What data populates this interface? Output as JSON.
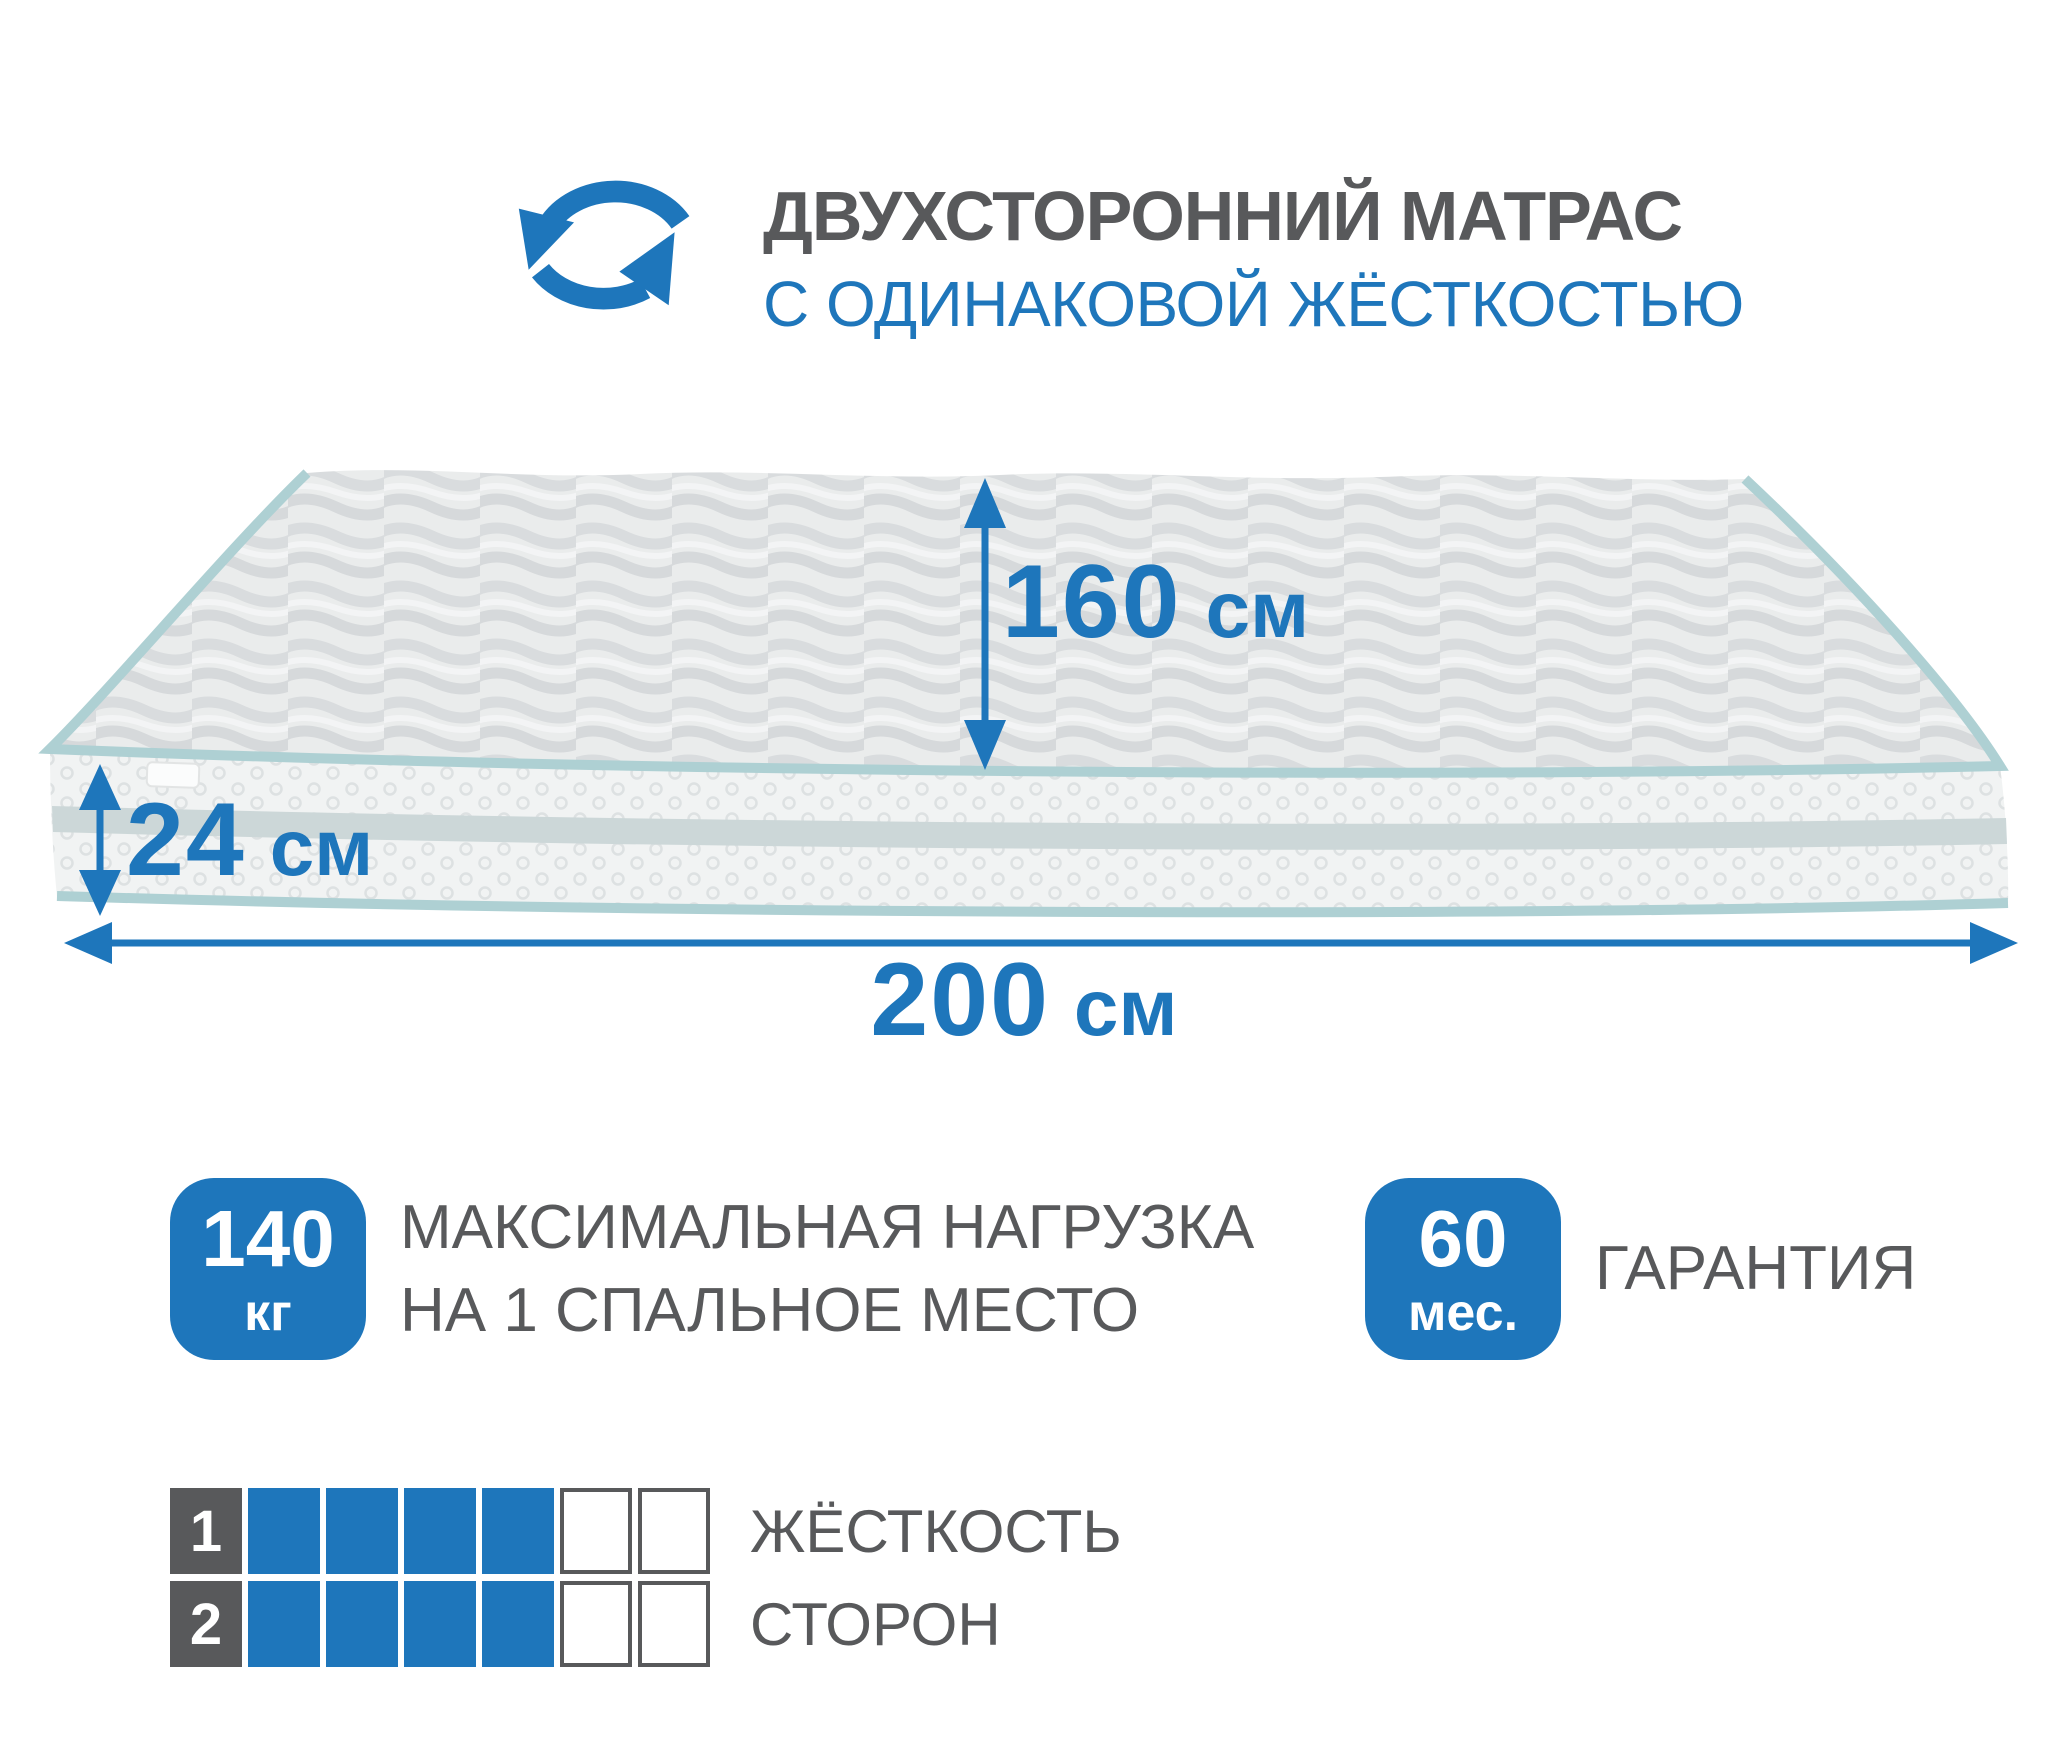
{
  "colors": {
    "accent_blue": "#1e76bb",
    "text_gray": "#58595b",
    "piping_teal": "#aed0d3"
  },
  "header": {
    "icon_name": "rotate-arrows-icon",
    "title": "ДВУХСТОРОННИЙ МАТРАС",
    "subtitle": "С ОДИНАКОВОЙ ЖЁСТКОСТЬЮ"
  },
  "dimensions": {
    "width": {
      "value": "160",
      "unit": "см"
    },
    "height": {
      "value": "24",
      "unit": "см"
    },
    "length": {
      "value": "200",
      "unit": "см"
    }
  },
  "features": [
    {
      "badge_value": "140",
      "badge_unit": "кг",
      "caption_line1": "МАКСИМАЛЬНАЯ НАГРУЗКА",
      "caption_line2": "НА 1 СПАЛЬНОЕ МЕСТО"
    },
    {
      "badge_value": "60",
      "badge_unit": "мес.",
      "caption_line1": "ГАРАНТИЯ",
      "caption_line2": ""
    }
  ],
  "firmness": {
    "caption_line1": "ЖЁСТКОСТЬ",
    "caption_line2": "СТОРОН",
    "scale_total": 6,
    "rows": [
      {
        "index": "1",
        "filled": 4
      },
      {
        "index": "2",
        "filled": 4
      }
    ]
  }
}
